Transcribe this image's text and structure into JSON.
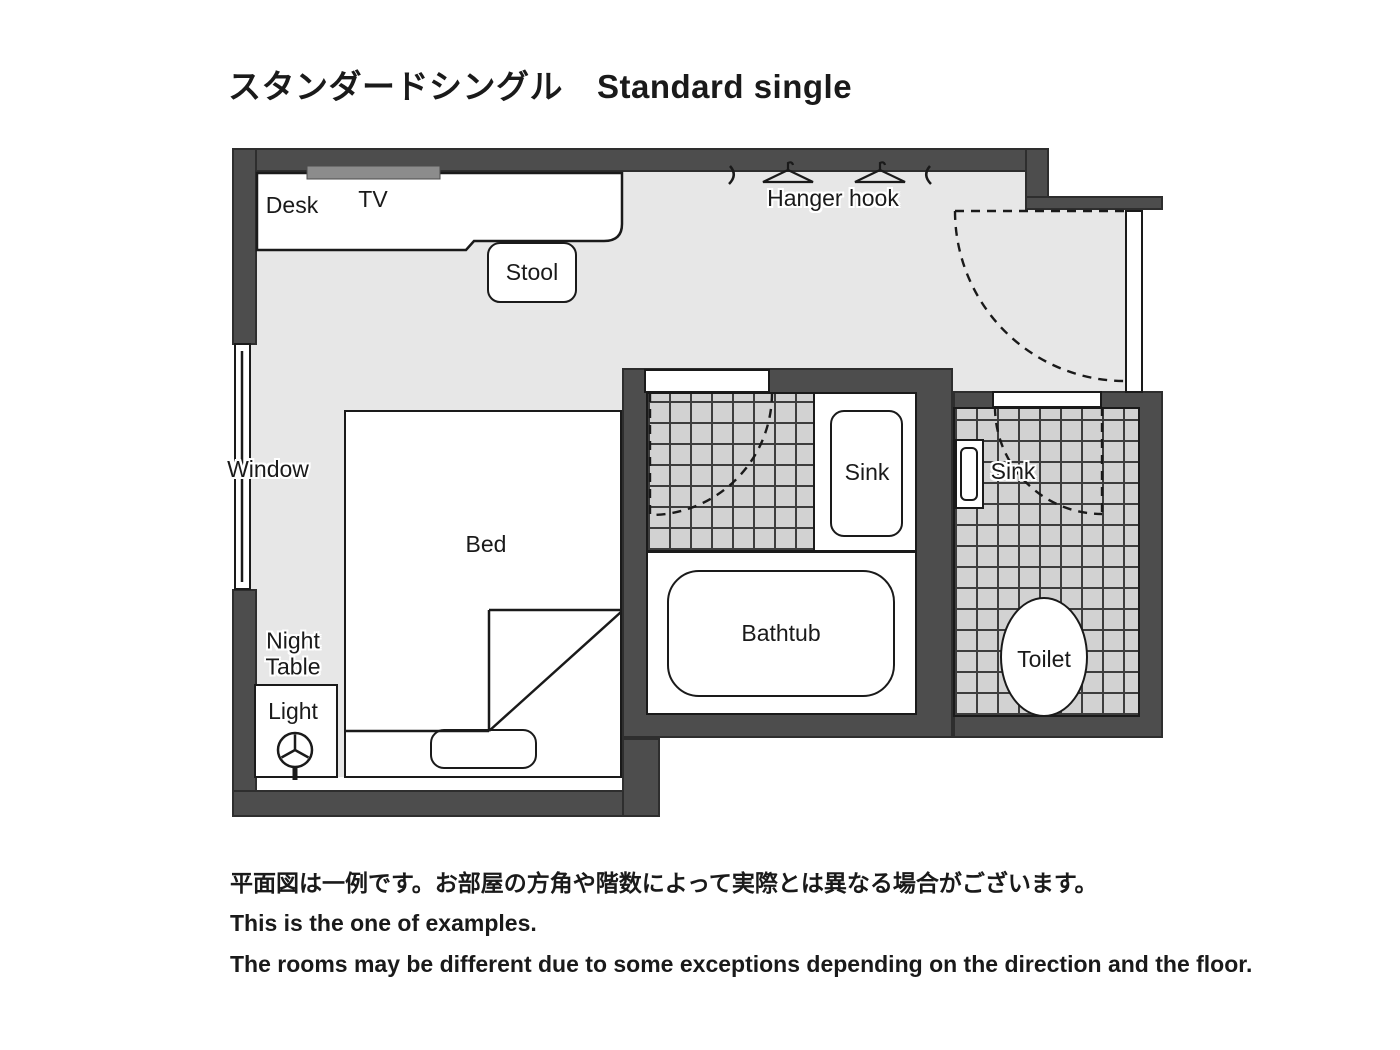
{
  "title": {
    "jp": "スタンダードシングル",
    "en": "Standard single"
  },
  "labels": {
    "desk": "Desk",
    "tv": "TV",
    "stool": "Stool",
    "hanger_hook": "Hanger hook",
    "window": "Window",
    "bed": "Bed",
    "night_table": "Night\nTable",
    "light": "Light",
    "sink_bathroom": "Sink",
    "sink_toilet": "Sink",
    "bathtub": "Bathtub",
    "toilet": "Toilet"
  },
  "footer": {
    "line1_jp": "平面図は一例です。お部屋の方角や階数によって実際とは異なる場合がございます。",
    "line2_en": "This is the one of examples.",
    "line3_en": "The rooms may be different due to some exceptions depending on the direction and the floor."
  },
  "icons": {
    "lamp": "lamp-icon",
    "hanger": "hanger-icon",
    "hook": "hook-icon",
    "door_swing": "door-swing-arc"
  },
  "colors": {
    "wall": "#4d4d4d",
    "floor": "#e7e7e7",
    "tile": "#d2d2d2",
    "tile_line": "#3d3d3d",
    "line": "#1a1a1a",
    "tv": "#8c8c8c"
  }
}
